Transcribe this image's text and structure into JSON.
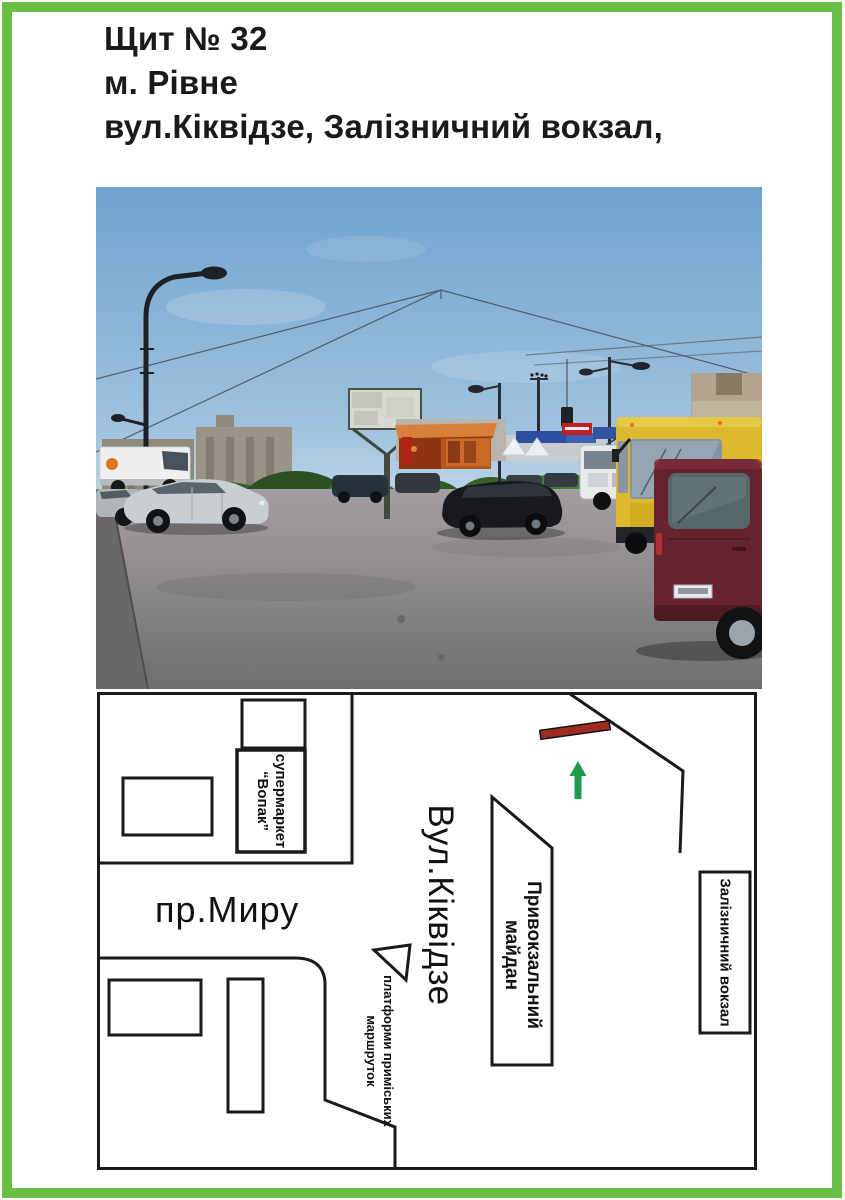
{
  "header": {
    "billboard_number": "Щит № 32",
    "city": "м. Рівне",
    "address": "вул.Кіквідзе, Залізничний вокзал,"
  },
  "map": {
    "street_horizontal": "пр.Миру",
    "street_vertical": "Вул.Кіквідзе",
    "supermarket_line1": "супермаркет",
    "supermarket_line2": "“Вопак”",
    "square_line1": "Привокзальний",
    "square_line2": "майдан",
    "station": "Залізничний вокзал",
    "platforms_line1": "платформи приміських",
    "platforms_line2": "маршруток"
  },
  "colors": {
    "frame_green": "#6ABE45",
    "billboard_marker_red": "#9C2B20",
    "direction_arrow_green": "#219B48",
    "map_line_black": "#1a1a1a"
  }
}
